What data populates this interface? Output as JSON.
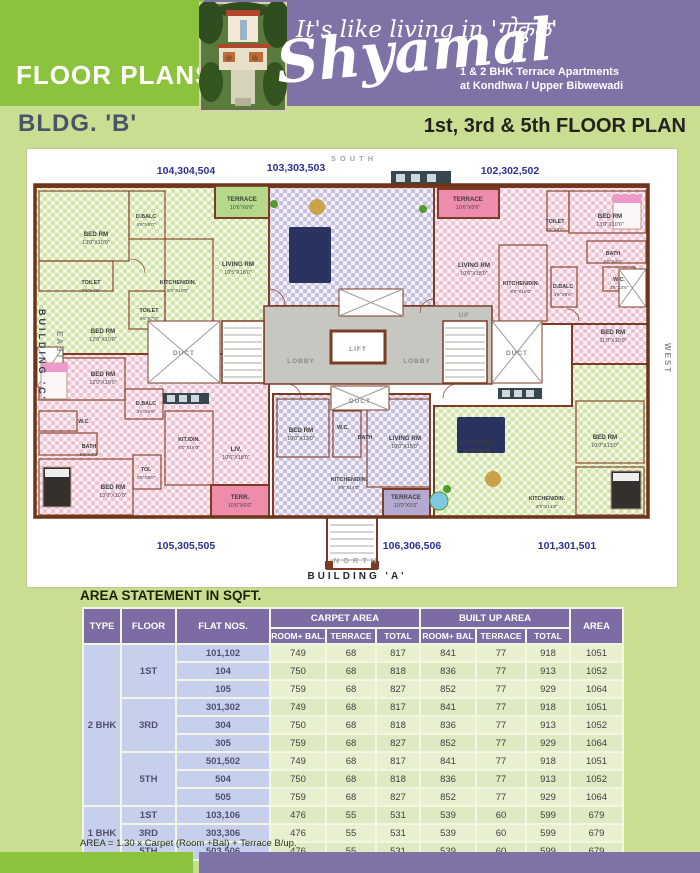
{
  "header": {
    "floor_plans": "FLOOR PLANS",
    "tagline": "It's like living in 'गोकुळ'",
    "brand": "Shyamal",
    "subtitle1": "1 & 2 BHK Terrace Apartments",
    "subtitle2": "at Kondhwa / Upper Bibwewadi",
    "bldg": "BLDG. 'B'",
    "plan_title": "1st, 3rd & 5th FLOOR PLAN"
  },
  "colors": {
    "accent_green": "#8cc33c",
    "accent_purple": "#7f72a6",
    "page_green": "#cade92",
    "flat_label_navy": "#2e3192",
    "wall_brown": "#7b3b24"
  },
  "plan": {
    "compass": {
      "south": "SOUTH",
      "north": "NORTH",
      "east": "EAST",
      "west": "WEST"
    },
    "building_a": "BUILDING  'A'",
    "building_c": "BUILDING 'C'",
    "flats": [
      {
        "t": "104,304,504",
        "x": 159,
        "y": 25
      },
      {
        "t": "103,303,503",
        "x": 269,
        "y": 22
      },
      {
        "t": "102,302,502",
        "x": 483,
        "y": 25
      },
      {
        "t": "105,305,505",
        "x": 159,
        "y": 400
      },
      {
        "t": "106,306,506",
        "x": 385,
        "y": 400
      },
      {
        "t": "101,301,501",
        "x": 540,
        "y": 400
      }
    ],
    "rooms": [
      {
        "t": "TERRACE",
        "d": "10'6\"X6'6\"",
        "x": 215,
        "y": 52
      },
      {
        "t": "BED RM",
        "d": "13'0\"X10'0\"",
        "x": 69,
        "y": 87
      },
      {
        "t": "D.BALC",
        "d": "4'6\"X8'0\"",
        "x": 119,
        "y": 69,
        "s": 1
      },
      {
        "t": "TOILET",
        "d": "7'6\"X4'6\"",
        "x": 64,
        "y": 135,
        "s": 1
      },
      {
        "t": "KITCHEN/DIN.",
        "d": "8'0\"X18'0\"",
        "x": 151,
        "y": 135,
        "s": 1
      },
      {
        "t": "LIVING RM",
        "d": "10'5\"X18'0\"",
        "x": 211,
        "y": 117
      },
      {
        "t": "BED RM",
        "d": "12'0\"X10'0\"",
        "x": 76,
        "y": 184
      },
      {
        "t": "TOILET",
        "d": "4'6\"X7'0\"",
        "x": 122,
        "y": 163,
        "s": 1
      },
      {
        "t": "TERRACE",
        "d": "10'6\"X6'6\"",
        "x": 441,
        "y": 52
      },
      {
        "t": "TOILET",
        "d": "4'6\"X8'0\"",
        "x": 528,
        "y": 74,
        "s": 1
      },
      {
        "t": "BED RM",
        "d": "13'0\"X10'0\"",
        "x": 583,
        "y": 69
      },
      {
        "t": "BATH",
        "d": "6'6\"X4'0\"",
        "x": 586,
        "y": 106,
        "s": 1
      },
      {
        "t": "LIVING RM",
        "d": "10'6\"X18'0\"",
        "x": 447,
        "y": 118
      },
      {
        "t": "KITCHEN/DIN.",
        "d": "8'0\"X18'0\"",
        "x": 494,
        "y": 136,
        "s": 1
      },
      {
        "t": "D.BALC",
        "d": "4'6\"X6'6\"",
        "x": 536,
        "y": 139,
        "s": 1
      },
      {
        "t": "W.C.",
        "d": "3'6\"X4'6\"",
        "x": 592,
        "y": 132,
        "s": 1
      },
      {
        "t": "BED RM",
        "d": "11'0\"X10'0\"",
        "x": 586,
        "y": 185
      },
      {
        "t": "BED RM",
        "d": "12'0\"X10'0\"",
        "x": 76,
        "y": 227
      },
      {
        "t": "D.BALC",
        "d": "4'6\"X6'6\"",
        "x": 119,
        "y": 256,
        "s": 1
      },
      {
        "t": "W.C.",
        "x": 57,
        "y": 274,
        "s": 1
      },
      {
        "t": "BATH",
        "d": "8'6\"X4'0\"",
        "x": 62,
        "y": 299,
        "s": 1
      },
      {
        "t": "BED RM",
        "d": "13'0\"X10'0\"",
        "x": 86,
        "y": 340
      },
      {
        "t": "TOI.",
        "d": "4'6\"X8'0\"",
        "x": 119,
        "y": 322,
        "s": 1
      },
      {
        "t": "KIT./DIN.",
        "d": "8'0\"X18'0\"",
        "x": 162,
        "y": 292,
        "s": 1
      },
      {
        "t": "LIV.",
        "d": "10'6\"X18'0\"",
        "x": 209,
        "y": 302
      },
      {
        "t": "TERR.",
        "d": "10'6\"X6'6\"",
        "x": 213,
        "y": 350
      },
      {
        "t": "BED RM",
        "d": "10'0\"X13'0\"",
        "x": 274,
        "y": 283
      },
      {
        "t": "W.C.",
        "x": 316,
        "y": 280,
        "s": 1
      },
      {
        "t": "BATH",
        "x": 338,
        "y": 290,
        "s": 1
      },
      {
        "t": "LIVING RM",
        "d": "10'0\"X15'0\"",
        "x": 378,
        "y": 291
      },
      {
        "t": "KITCHEN/DIN.",
        "d": "8'6\"X14'0\"",
        "x": 322,
        "y": 332,
        "s": 1
      },
      {
        "t": "TERRACE",
        "d": "10'0\"X5'6\"",
        "x": 379,
        "y": 350
      },
      {
        "t": "BED RM",
        "d": "10'0\"X13'0\"",
        "x": 578,
        "y": 290
      },
      {
        "t": "KITCHEN/DIN.",
        "d": "8'6\"X14'0\"",
        "x": 520,
        "y": 351,
        "s": 1
      },
      {
        "t": "LIVING RM",
        "d": "10'0\"X15'0\"",
        "x": 450,
        "y": 296
      },
      {
        "t": "LOBBY",
        "x": 274,
        "y": 214,
        "c": 1
      },
      {
        "t": "LOBBY",
        "x": 390,
        "y": 214,
        "c": 1
      },
      {
        "t": "LIFT",
        "x": 331,
        "y": 202,
        "c": 1
      },
      {
        "t": "DUCT",
        "x": 157,
        "y": 206,
        "c": 1
      },
      {
        "t": "DUCT",
        "x": 490,
        "y": 206,
        "c": 1
      },
      {
        "t": "DUCT",
        "x": 333,
        "y": 254,
        "c": 1
      },
      {
        "t": "UP",
        "x": 437,
        "y": 168,
        "c": 1
      }
    ]
  },
  "table": {
    "title": "AREA STATEMENT IN SQFT.",
    "headers": {
      "type": "TYPE",
      "floor": "FLOOR",
      "flat": "FLAT NOS.",
      "carpet": "CARPET  AREA",
      "builtup": "BUILT UP  AREA",
      "area": "AREA",
      "sub": [
        "ROOM+ BAL.",
        "TERRACE",
        "TOTAL",
        "ROOM+ BAL",
        "TERRACE",
        "TOTAL"
      ]
    },
    "rows": [
      {
        "type": "2 BHK",
        "tspan": 9,
        "floor": "1ST",
        "fspan": 3,
        "flat": "101,102",
        "v": [
          "749",
          "68",
          "817",
          "841",
          "77",
          "918",
          "1051"
        ]
      },
      {
        "flat": "104",
        "v": [
          "750",
          "68",
          "818",
          "836",
          "77",
          "913",
          "1052"
        ]
      },
      {
        "flat": "105",
        "v": [
          "759",
          "68",
          "827",
          "852",
          "77",
          "929",
          "1064"
        ]
      },
      {
        "floor": "3RD",
        "fspan": 3,
        "flat": "301,302",
        "v": [
          "749",
          "68",
          "817",
          "841",
          "77",
          "918",
          "1051"
        ]
      },
      {
        "flat": "304",
        "v": [
          "750",
          "68",
          "818",
          "836",
          "77",
          "913",
          "1052"
        ]
      },
      {
        "flat": "305",
        "v": [
          "759",
          "68",
          "827",
          "852",
          "77",
          "929",
          "1064"
        ]
      },
      {
        "floor": "5TH",
        "fspan": 3,
        "flat": "501,502",
        "v": [
          "749",
          "68",
          "817",
          "841",
          "77",
          "918",
          "1051"
        ]
      },
      {
        "flat": "504",
        "v": [
          "750",
          "68",
          "818",
          "836",
          "77",
          "913",
          "1052"
        ]
      },
      {
        "flat": "505",
        "v": [
          "759",
          "68",
          "827",
          "852",
          "77",
          "929",
          "1064"
        ]
      },
      {
        "type": "1 BHK",
        "tspan": 3,
        "floor": "1ST",
        "fspan": 1,
        "flat": "103,106",
        "v": [
          "476",
          "55",
          "531",
          "539",
          "60",
          "599",
          "679"
        ]
      },
      {
        "floor": "3RD",
        "fspan": 1,
        "flat": "303,306",
        "v": [
          "476",
          "55",
          "531",
          "539",
          "60",
          "599",
          "679"
        ]
      },
      {
        "floor": "5TH",
        "fspan": 1,
        "flat": "503,506",
        "v": [
          "476",
          "55",
          "531",
          "539",
          "60",
          "599",
          "679"
        ]
      }
    ],
    "note": "AREA = 1.30 x Carpet (Room +Bal) + Terrace B/up."
  }
}
